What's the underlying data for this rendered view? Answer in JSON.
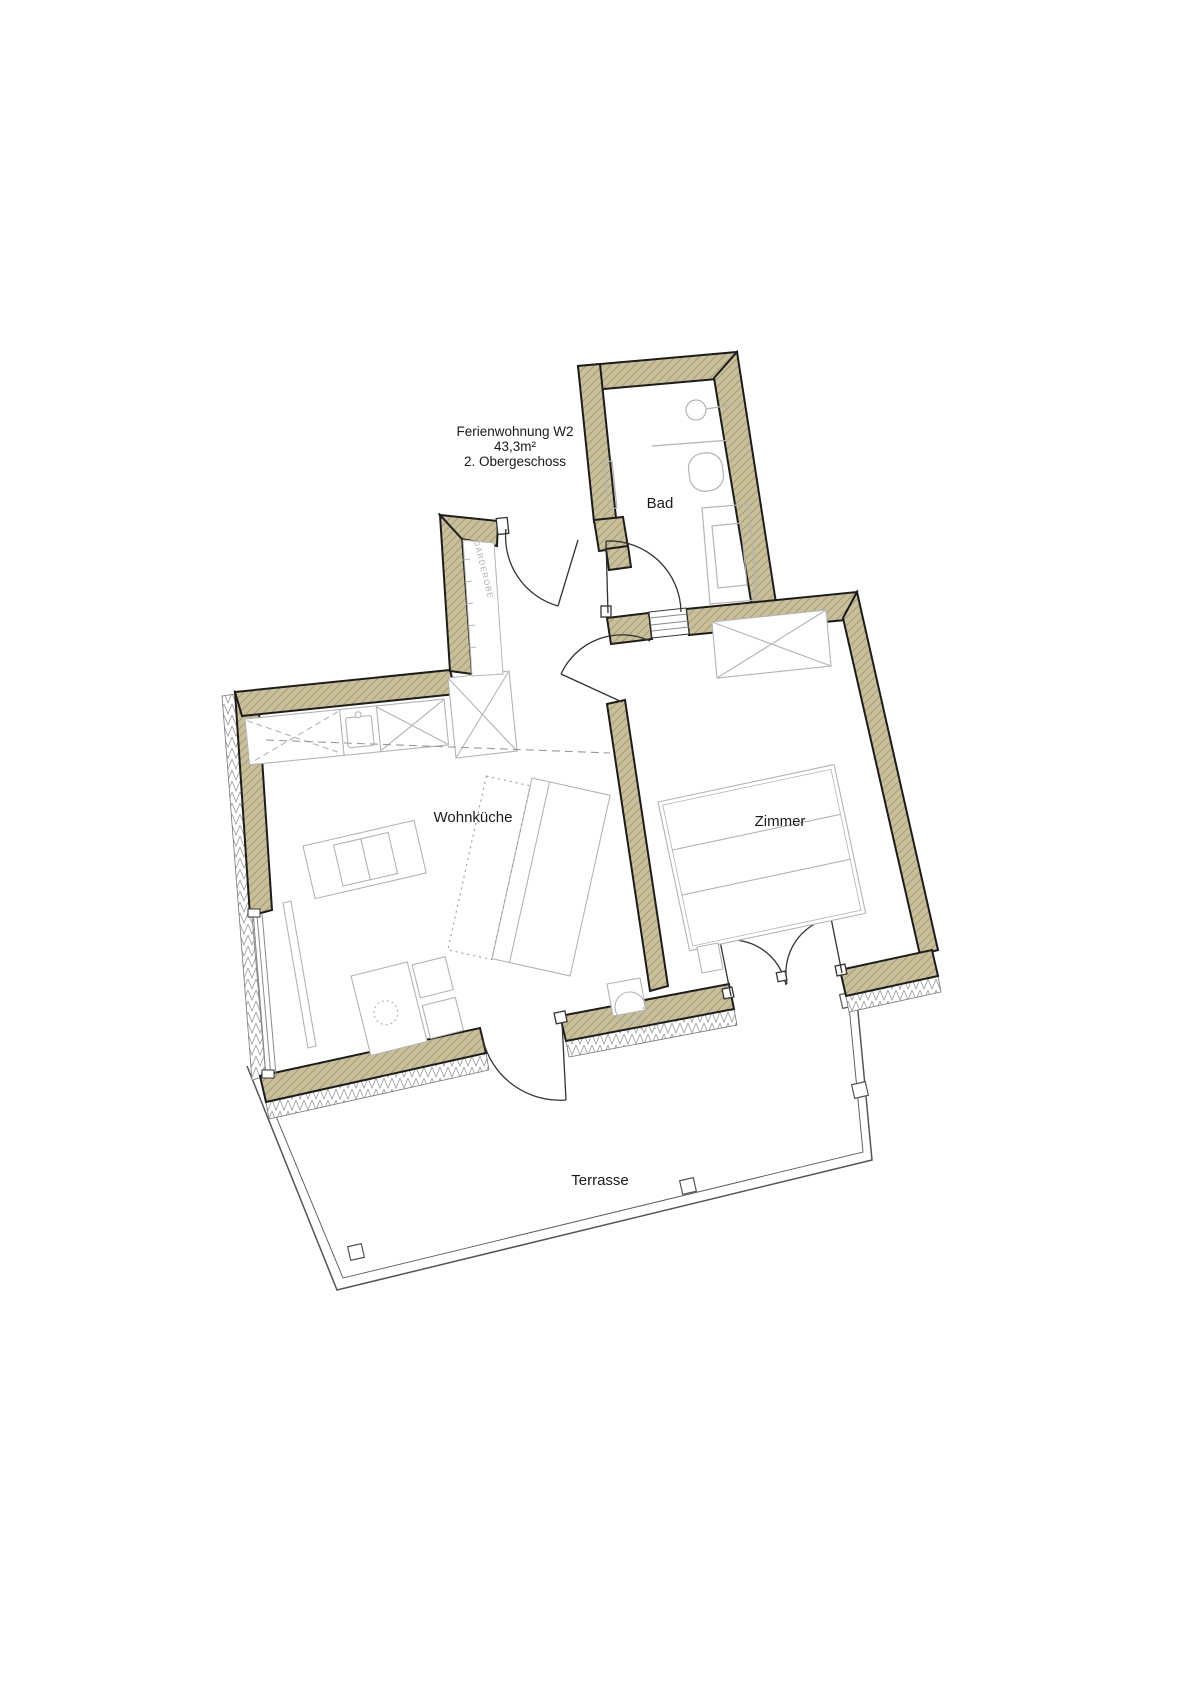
{
  "plan": {
    "title": "Ferienwohnung W2",
    "area": "43,3m²",
    "floor": "2. Obergeschoss"
  },
  "rooms": {
    "bad": "Bad",
    "wohnkueche": "Wohnküche",
    "zimmer": "Zimmer",
    "terrasse": "Terrasse",
    "garderobe": "GARDEROBE"
  },
  "colors": {
    "wall_fill": "#c9c09a",
    "wall_hatch": "#a69d79",
    "wall_outline": "#1c1c1c",
    "furniture_line": "#b4b4b4",
    "thin_line": "#8a8a8a",
    "label_text": "#1a1a1a",
    "muted_text": "#b0b0ae"
  }
}
